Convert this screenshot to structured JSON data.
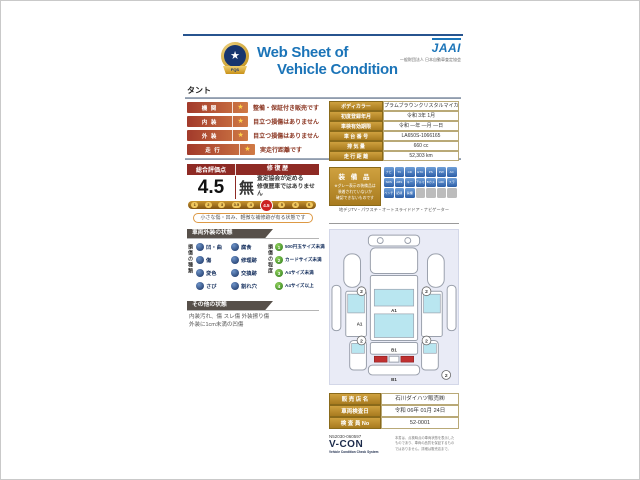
{
  "header": {
    "title_line1": "Web Sheet of",
    "title_line2": "Vehicle Condition",
    "org_logo": "JAAI",
    "org_name": "一般財団法人 日本自動車査定協会",
    "badge_star": "★",
    "badge_text": "FQS"
  },
  "car_name": "タント",
  "ratings": [
    {
      "label": "機 関",
      "star": "★",
      "comment": "整備・保証付き販売です"
    },
    {
      "label": "内 装",
      "star": "★",
      "comment": "目立つ損傷はありません"
    },
    {
      "label": "外 装",
      "star": "★",
      "comment": "目立つ損傷はありません"
    },
    {
      "label": "走 行",
      "star": "★",
      "comment": "実走行距離です"
    }
  ],
  "overall": {
    "score_header": "総合評価点",
    "repair_header": "修 復 歴",
    "score": "4.5",
    "repair_value": "無",
    "repair_note_line1": "査定協会が定める",
    "repair_note_line2": "修復歴車ではありません",
    "scale": [
      "1",
      "2",
      "3",
      "3.5",
      "4",
      "4.5",
      "5",
      "6",
      "S"
    ],
    "scale_highlight": "4.5",
    "scale_note": "小さな傷・凹み、軽微な補修跡が有る状態です"
  },
  "exterior": {
    "title": "車両外装の状態",
    "types_label": "損傷の種類",
    "types": [
      "凹・曲",
      "傷",
      "変色",
      "さび",
      "腐食",
      "修理跡",
      "交換跡",
      "割れ穴"
    ],
    "levels_label": "損傷の程度",
    "levels": [
      {
        "num": "1",
        "label": "500円玉サイズ未満"
      },
      {
        "num": "2",
        "label": "カードサイズ未満"
      },
      {
        "num": "3",
        "label": "A4サイズ未満"
      },
      {
        "num": "4",
        "label": "A4サイズ以上"
      }
    ]
  },
  "other": {
    "title": "その他の状態",
    "line1": "内装汚れ、傷 スレ傷 外装擦り傷",
    "line2": "外装に1cm未満の凹傷"
  },
  "vehicle_info": {
    "rows": [
      {
        "label": "ボディカラー",
        "value": "プラムブラウンクリスタルマイカ"
      },
      {
        "label": "初度登録年月",
        "value": "令和 3年 1月"
      },
      {
        "label": "車検有効期限",
        "value": "令和 ―年 ―月 ―日"
      },
      {
        "label": "車 台 番 号",
        "value": "LA650S-1066165"
      },
      {
        "label": "排 気 量",
        "value": "660 cc"
      },
      {
        "label": "走 行 距 離",
        "value": "52,303 km"
      }
    ]
  },
  "equipment": {
    "title": "装 備 品",
    "note_line1": "※グレー表示の装備品は",
    "note_line2": "装着されていないか",
    "note_line3": "確認できないものです",
    "caption": "地デジTV・パワステ・オートスライドドア・ナビゲーター",
    "icons": [
      {
        "label": "ナビ",
        "active": true
      },
      {
        "label": "TV",
        "active": true
      },
      {
        "label": "CD",
        "active": true
      },
      {
        "label": "ETC",
        "active": true
      },
      {
        "label": "PS",
        "active": true
      },
      {
        "label": "PW",
        "active": true
      },
      {
        "label": "AC",
        "active": true
      },
      {
        "label": "SRS",
        "active": true
      },
      {
        "label": "ABS",
        "active": true
      },
      {
        "label": "キー",
        "active": true
      },
      {
        "label": "アルミ",
        "active": true
      },
      {
        "label": "Bカメ",
        "active": true
      },
      {
        "label": "HID",
        "active": true
      },
      {
        "label": "スラ",
        "active": true
      },
      {
        "label": "ベンチ",
        "active": true
      },
      {
        "label": "記録",
        "active": true
      },
      {
        "label": "禁煙",
        "active": true
      },
      {
        "label": "",
        "active": false
      },
      {
        "label": "",
        "active": false
      },
      {
        "label": "",
        "active": false
      },
      {
        "label": "",
        "active": false
      }
    ]
  },
  "diagram": {
    "markers": [
      {
        "label": "2"
      },
      {
        "label": "2"
      },
      {
        "label": "2"
      },
      {
        "label": "2"
      },
      {
        "label": "A1"
      },
      {
        "label": "A1"
      },
      {
        "label": "B1"
      },
      {
        "label": "B1"
      },
      {
        "label": "2"
      }
    ]
  },
  "dealer": {
    "rows": [
      {
        "label": "販 売 店 名",
        "value": "石川ダイハツ販売㈱"
      },
      {
        "label": "車両検査日",
        "value": "令和 06年 01月 24日"
      },
      {
        "label": "検 査 員 No",
        "value": "52-0001"
      }
    ],
    "sheet_no": "N52030-060597",
    "system_logo": "V-CON",
    "system_subtitle": "Vehicle Condition Check System",
    "fine_print_line1": "本書は、点検時点の車両状態を表示した",
    "fine_print_line2": "ものであり、車両の品質を保証するもの",
    "fine_print_line3": "ではありません。詳細は販売店まで。"
  }
}
